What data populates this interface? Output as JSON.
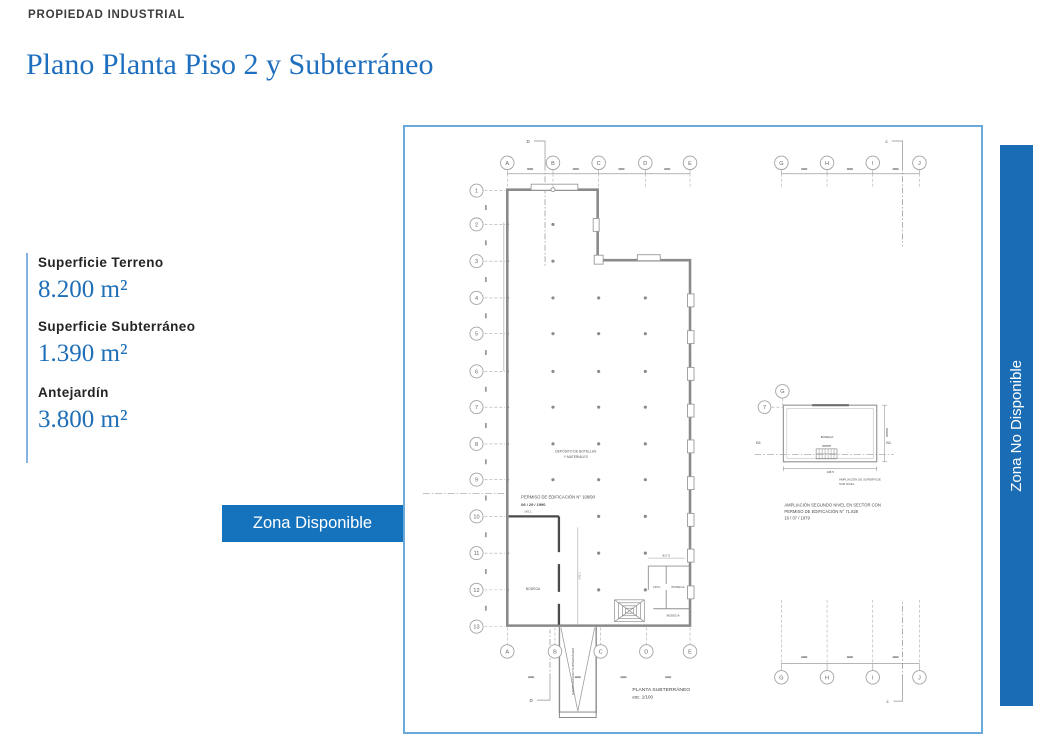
{
  "page": {
    "kicker": "PROPIEDAD INDUSTRIAL",
    "title": "Plano Planta Piso 2 y Subterráneo"
  },
  "stats": {
    "items": [
      {
        "label": "Superficie Terreno",
        "value": "8.200 m²"
      },
      {
        "label": "Superficie Subterráneo",
        "value": "1.390 m²"
      },
      {
        "label": "Antejardín",
        "value": "3.800 m²"
      }
    ]
  },
  "legend": {
    "available": "Zona Disponible",
    "unavailable": "Zona No Disponible"
  },
  "colors": {
    "title_blue": "#1f6fbf",
    "legend_blue": "#1573be",
    "bar_blue": "#1a6cb4",
    "plan_border_blue": "#69aada",
    "accent_line_blue": "#85b4e0"
  },
  "plan": {
    "grid": {
      "top_left_letters": [
        "A",
        "B",
        "C",
        "D",
        "E"
      ],
      "top_right_letters": [
        "G",
        "H",
        "I",
        "J"
      ],
      "bottom_left_letters": [
        "A",
        "B",
        "C",
        "D",
        "E"
      ],
      "bottom_right_letters": [
        "G",
        "H",
        "I",
        "J"
      ],
      "row_numbers": [
        "1",
        "2",
        "3",
        "4",
        "5",
        "6",
        "7",
        "8",
        "9",
        "10",
        "11",
        "12",
        "13"
      ],
      "annex_row_number": "7",
      "annex_col_letter": "G",
      "bracket_top_left": "D",
      "bracket_top_right": "c",
      "bracket_bottom_left": "D",
      "bracket_bottom_right": "c"
    },
    "labels": {
      "permiso_line1": "PERMISO DE EDIFICACIÓN N° 108/90",
      "permiso_line2": "06 / 29 / 1990",
      "permiso_dim": "142.1",
      "deposito_line1": "DEPÓSITO DE BOTELLAS",
      "deposito_line2": "Y MATERIALES",
      "bodega": "BODEGA",
      "ofic": "OFIC.",
      "bodega_right": "BODEGA",
      "bodega_lower": "BODEGA",
      "rooms_dim": "817.5",
      "ramp_text": "RAMPA ACCESO SUBTERRÁNEO",
      "annex_b1_left": "B1",
      "annex_b1_right": "B1",
      "annex_bodega": "BODEGA",
      "annex_dim_bottom": "138.5",
      "annex_caption_line1": "AMPLIACIÓN DE SUPERFICIE",
      "annex_caption_line2": "SUB NIVEL",
      "ampliacion_line1": "AMPLIACIÓN SEGUNDO NIVEL EN SECTOR CON",
      "ampliacion_line2": "PERMISO DE EDIFICACIÓN N° 71.828",
      "ampliacion_line3": "16 / 07 / 1979",
      "title_line1": "PLANTA SUBTERRÁNEO",
      "title_line2": "esc.   1/100"
    }
  }
}
